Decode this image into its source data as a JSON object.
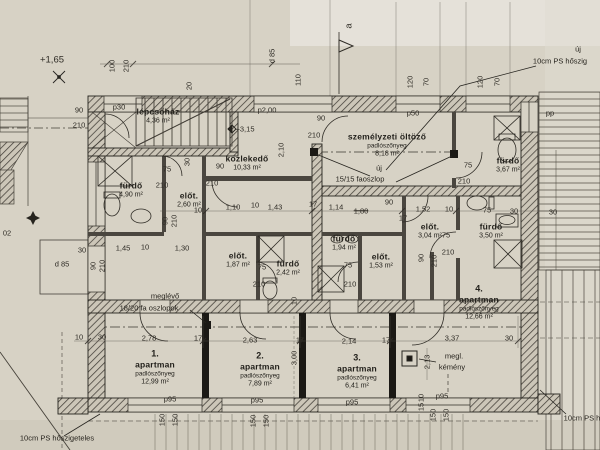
{
  "meta": {
    "kind": "architectural floor plan scan",
    "language": "Hungarian"
  },
  "colors": {
    "paper": "#d7d2c5",
    "ink": "#2e2b25",
    "wall": "#3c3831",
    "black": "#1b1915"
  },
  "rooms": [
    {
      "name": "lépcsőház",
      "area": "4,36 m²",
      "x": 158,
      "y": 116
    },
    {
      "name": "közlekedő",
      "area": "10,33 m²",
      "x": 247,
      "y": 163
    },
    {
      "name": "személyzeti öltöző",
      "floor": "padlószőnyeg",
      "area": "8,18 m²",
      "x": 387,
      "y": 145
    },
    {
      "name": "fürdő",
      "area": "3,67 m²",
      "x": 508,
      "y": 165
    },
    {
      "name": "fürdő",
      "area": "4,90 m²",
      "x": 131,
      "y": 190
    },
    {
      "name": "előt.",
      "area": "2,60 m²",
      "x": 189,
      "y": 200
    },
    {
      "name": "előt.",
      "area": "1,87 m²",
      "x": 238,
      "y": 260
    },
    {
      "name": "fürdő",
      "area": "2,42 m²",
      "x": 288,
      "y": 268
    },
    {
      "name": "fürdő",
      "area": "1,94 m²",
      "x": 344,
      "y": 243
    },
    {
      "name": "előt.",
      "area": "1,53 m²",
      "x": 381,
      "y": 261
    },
    {
      "name": "előt.",
      "area": "3,04 m²",
      "x": 430,
      "y": 231
    },
    {
      "name": "fürdő",
      "area": "3,50 m²",
      "x": 491,
      "y": 231
    },
    {
      "num": "1.",
      "name": "apartman",
      "floor": "padlószőnyeg",
      "area": "12,99 m²",
      "x": 155,
      "y": 368
    },
    {
      "num": "2.",
      "name": "apartman",
      "floor": "padlószőnyeg",
      "area": "7,89 m²",
      "x": 260,
      "y": 370
    },
    {
      "num": "3.",
      "name": "apartman",
      "floor": "padlószőnyeg",
      "area": "6,41 m²",
      "x": 357,
      "y": 372
    },
    {
      "num": "4.",
      "name": "apartman",
      "floor": "padlószőnyeg",
      "area": "12,66 m²",
      "x": 479,
      "y": 303
    }
  ],
  "dims": [
    {
      "t": "+1,65",
      "x": 52,
      "y": 60,
      "c": "med"
    },
    {
      "t": "100",
      "x": 112,
      "y": 66,
      "r": 1
    },
    {
      "t": "210",
      "x": 126,
      "y": 66,
      "r": 1
    },
    {
      "t": "20",
      "x": 189,
      "y": 86,
      "r": 1
    },
    {
      "t": "d 85",
      "x": 272,
      "y": 56,
      "r": 1
    },
    {
      "t": "110",
      "x": 298,
      "y": 80,
      "r": 1
    },
    {
      "t": "a",
      "x": 349,
      "y": 26,
      "r": 1,
      "c": "med"
    },
    {
      "t": "120",
      "x": 410,
      "y": 82,
      "r": 1
    },
    {
      "t": "70",
      "x": 426,
      "y": 82,
      "r": 1
    },
    {
      "t": "120",
      "x": 480,
      "y": 82,
      "r": 1
    },
    {
      "t": "70",
      "x": 497,
      "y": 82,
      "r": 1
    },
    {
      "t": "90",
      "x": 79,
      "y": 110
    },
    {
      "t": "210",
      "x": 79,
      "y": 125
    },
    {
      "t": "02",
      "x": 7,
      "y": 233
    },
    {
      "t": "30",
      "x": 82,
      "y": 250
    },
    {
      "t": "d 85",
      "x": 62,
      "y": 264
    },
    {
      "t": "90",
      "x": 93,
      "y": 266,
      "r": 1
    },
    {
      "t": "210",
      "x": 102,
      "y": 266,
      "r": 1
    },
    {
      "t": "10",
      "x": 79,
      "y": 337
    },
    {
      "t": "30",
      "x": 102,
      "y": 337
    },
    {
      "t": "2,78",
      "x": 149,
      "y": 338
    },
    {
      "t": "17",
      "x": 198,
      "y": 338
    },
    {
      "t": "2,63",
      "x": 250,
      "y": 340
    },
    {
      "t": "17",
      "x": 300,
      "y": 340
    },
    {
      "t": "2,14",
      "x": 349,
      "y": 341
    },
    {
      "t": "17",
      "x": 386,
      "y": 340
    },
    {
      "t": "3,37",
      "x": 452,
      "y": 338
    },
    {
      "t": "30",
      "x": 509,
      "y": 338
    },
    {
      "t": "3,00",
      "x": 294,
      "y": 358,
      "r": 1
    },
    {
      "t": "2,13",
      "x": 427,
      "y": 362,
      "r": 1
    },
    {
      "t": "75",
      "x": 167,
      "y": 169
    },
    {
      "t": "210",
      "x": 162,
      "y": 185
    },
    {
      "t": "30",
      "x": 187,
      "y": 162,
      "r": 1
    },
    {
      "t": "90",
      "x": 220,
      "y": 166
    },
    {
      "t": "210",
      "x": 212,
      "y": 183
    },
    {
      "t": "90",
      "x": 321,
      "y": 118
    },
    {
      "t": "210",
      "x": 314,
      "y": 135
    },
    {
      "t": "2,10",
      "x": 281,
      "y": 150,
      "r": 1
    },
    {
      "t": "75",
      "x": 468,
      "y": 165
    },
    {
      "t": "210",
      "x": 464,
      "y": 181
    },
    {
      "t": "1,45",
      "x": 123,
      "y": 248
    },
    {
      "t": "10",
      "x": 145,
      "y": 247
    },
    {
      "t": "1,30",
      "x": 182,
      "y": 248
    },
    {
      "t": "90",
      "x": 165,
      "y": 221,
      "r": 1
    },
    {
      "t": "210",
      "x": 174,
      "y": 221,
      "r": 1
    },
    {
      "t": "1,10",
      "x": 233,
      "y": 207
    },
    {
      "t": "10",
      "x": 255,
      "y": 205
    },
    {
      "t": "10",
      "x": 198,
      "y": 210
    },
    {
      "t": "1,43",
      "x": 275,
      "y": 207
    },
    {
      "t": "17",
      "x": 313,
      "y": 204
    },
    {
      "t": "1,14",
      "x": 336,
      "y": 207
    },
    {
      "t": "1,80",
      "x": 361,
      "y": 211,
      "s": 1
    },
    {
      "t": "90",
      "x": 389,
      "y": 202
    },
    {
      "t": "17",
      "x": 403,
      "y": 218
    },
    {
      "t": "1,52",
      "x": 423,
      "y": 209
    },
    {
      "t": "10",
      "x": 449,
      "y": 209
    },
    {
      "t": "75",
      "x": 487,
      "y": 210
    },
    {
      "t": "30",
      "x": 514,
      "y": 211
    },
    {
      "t": "30",
      "x": 553,
      "y": 212
    },
    {
      "t": "90",
      "x": 421,
      "y": 258,
      "r": 1
    },
    {
      "t": "210",
      "x": 434,
      "y": 261,
      "r": 1
    },
    {
      "t": "75",
      "x": 446,
      "y": 235
    },
    {
      "t": "210",
      "x": 448,
      "y": 252
    },
    {
      "t": "75",
      "x": 262,
      "y": 267
    },
    {
      "t": "210",
      "x": 259,
      "y": 284
    },
    {
      "t": "10",
      "x": 294,
      "y": 301,
      "r": 1
    },
    {
      "t": "75",
      "x": 348,
      "y": 265
    },
    {
      "t": "210",
      "x": 350,
      "y": 284
    },
    {
      "t": "+3,15",
      "x": 245,
      "y": 129
    },
    {
      "t": "150",
      "x": 162,
      "y": 420,
      "r": 1
    },
    {
      "t": "150",
      "x": 175,
      "y": 420,
      "r": 1
    },
    {
      "t": "150",
      "x": 253,
      "y": 421,
      "r": 1
    },
    {
      "t": "150",
      "x": 266,
      "y": 421,
      "r": 1
    },
    {
      "t": "150",
      "x": 433,
      "y": 415,
      "r": 1
    },
    {
      "t": "150",
      "x": 446,
      "y": 415,
      "r": 1
    },
    {
      "t": "10",
      "x": 421,
      "y": 398,
      "r": 1
    },
    {
      "t": "15",
      "x": 421,
      "y": 407,
      "r": 1
    }
  ],
  "plabels": [
    {
      "t": "p30",
      "x": 119,
      "y": 107
    },
    {
      "t": "p2,00",
      "x": 267,
      "y": 110
    },
    {
      "t": "p50",
      "x": 413,
      "y": 113
    },
    {
      "t": "pp",
      "x": 550,
      "y": 113
    },
    {
      "t": "p95",
      "x": 170,
      "y": 399
    },
    {
      "t": "p95",
      "x": 257,
      "y": 400
    },
    {
      "t": "p95",
      "x": 352,
      "y": 402
    },
    {
      "t": "p95",
      "x": 442,
      "y": 396
    }
  ],
  "notes": [
    {
      "t": "új",
      "x": 578,
      "y": 49
    },
    {
      "t": "10cm PS hőszig",
      "x": 560,
      "y": 61
    },
    {
      "t": "meglévő",
      "x": 165,
      "y": 296
    },
    {
      "t": "18/20 fa oszlopok",
      "x": 149,
      "y": 308
    },
    {
      "t": "új",
      "x": 379,
      "y": 168
    },
    {
      "t": "15/15 faoszlop",
      "x": 360,
      "y": 179
    },
    {
      "t": "megl.",
      "x": 454,
      "y": 356
    },
    {
      "t": "kémény",
      "x": 452,
      "y": 367
    },
    {
      "t": "10cm PS hőszigeteles",
      "x": 57,
      "y": 438
    },
    {
      "t": "10cm PS h",
      "x": 582,
      "y": 418
    }
  ]
}
